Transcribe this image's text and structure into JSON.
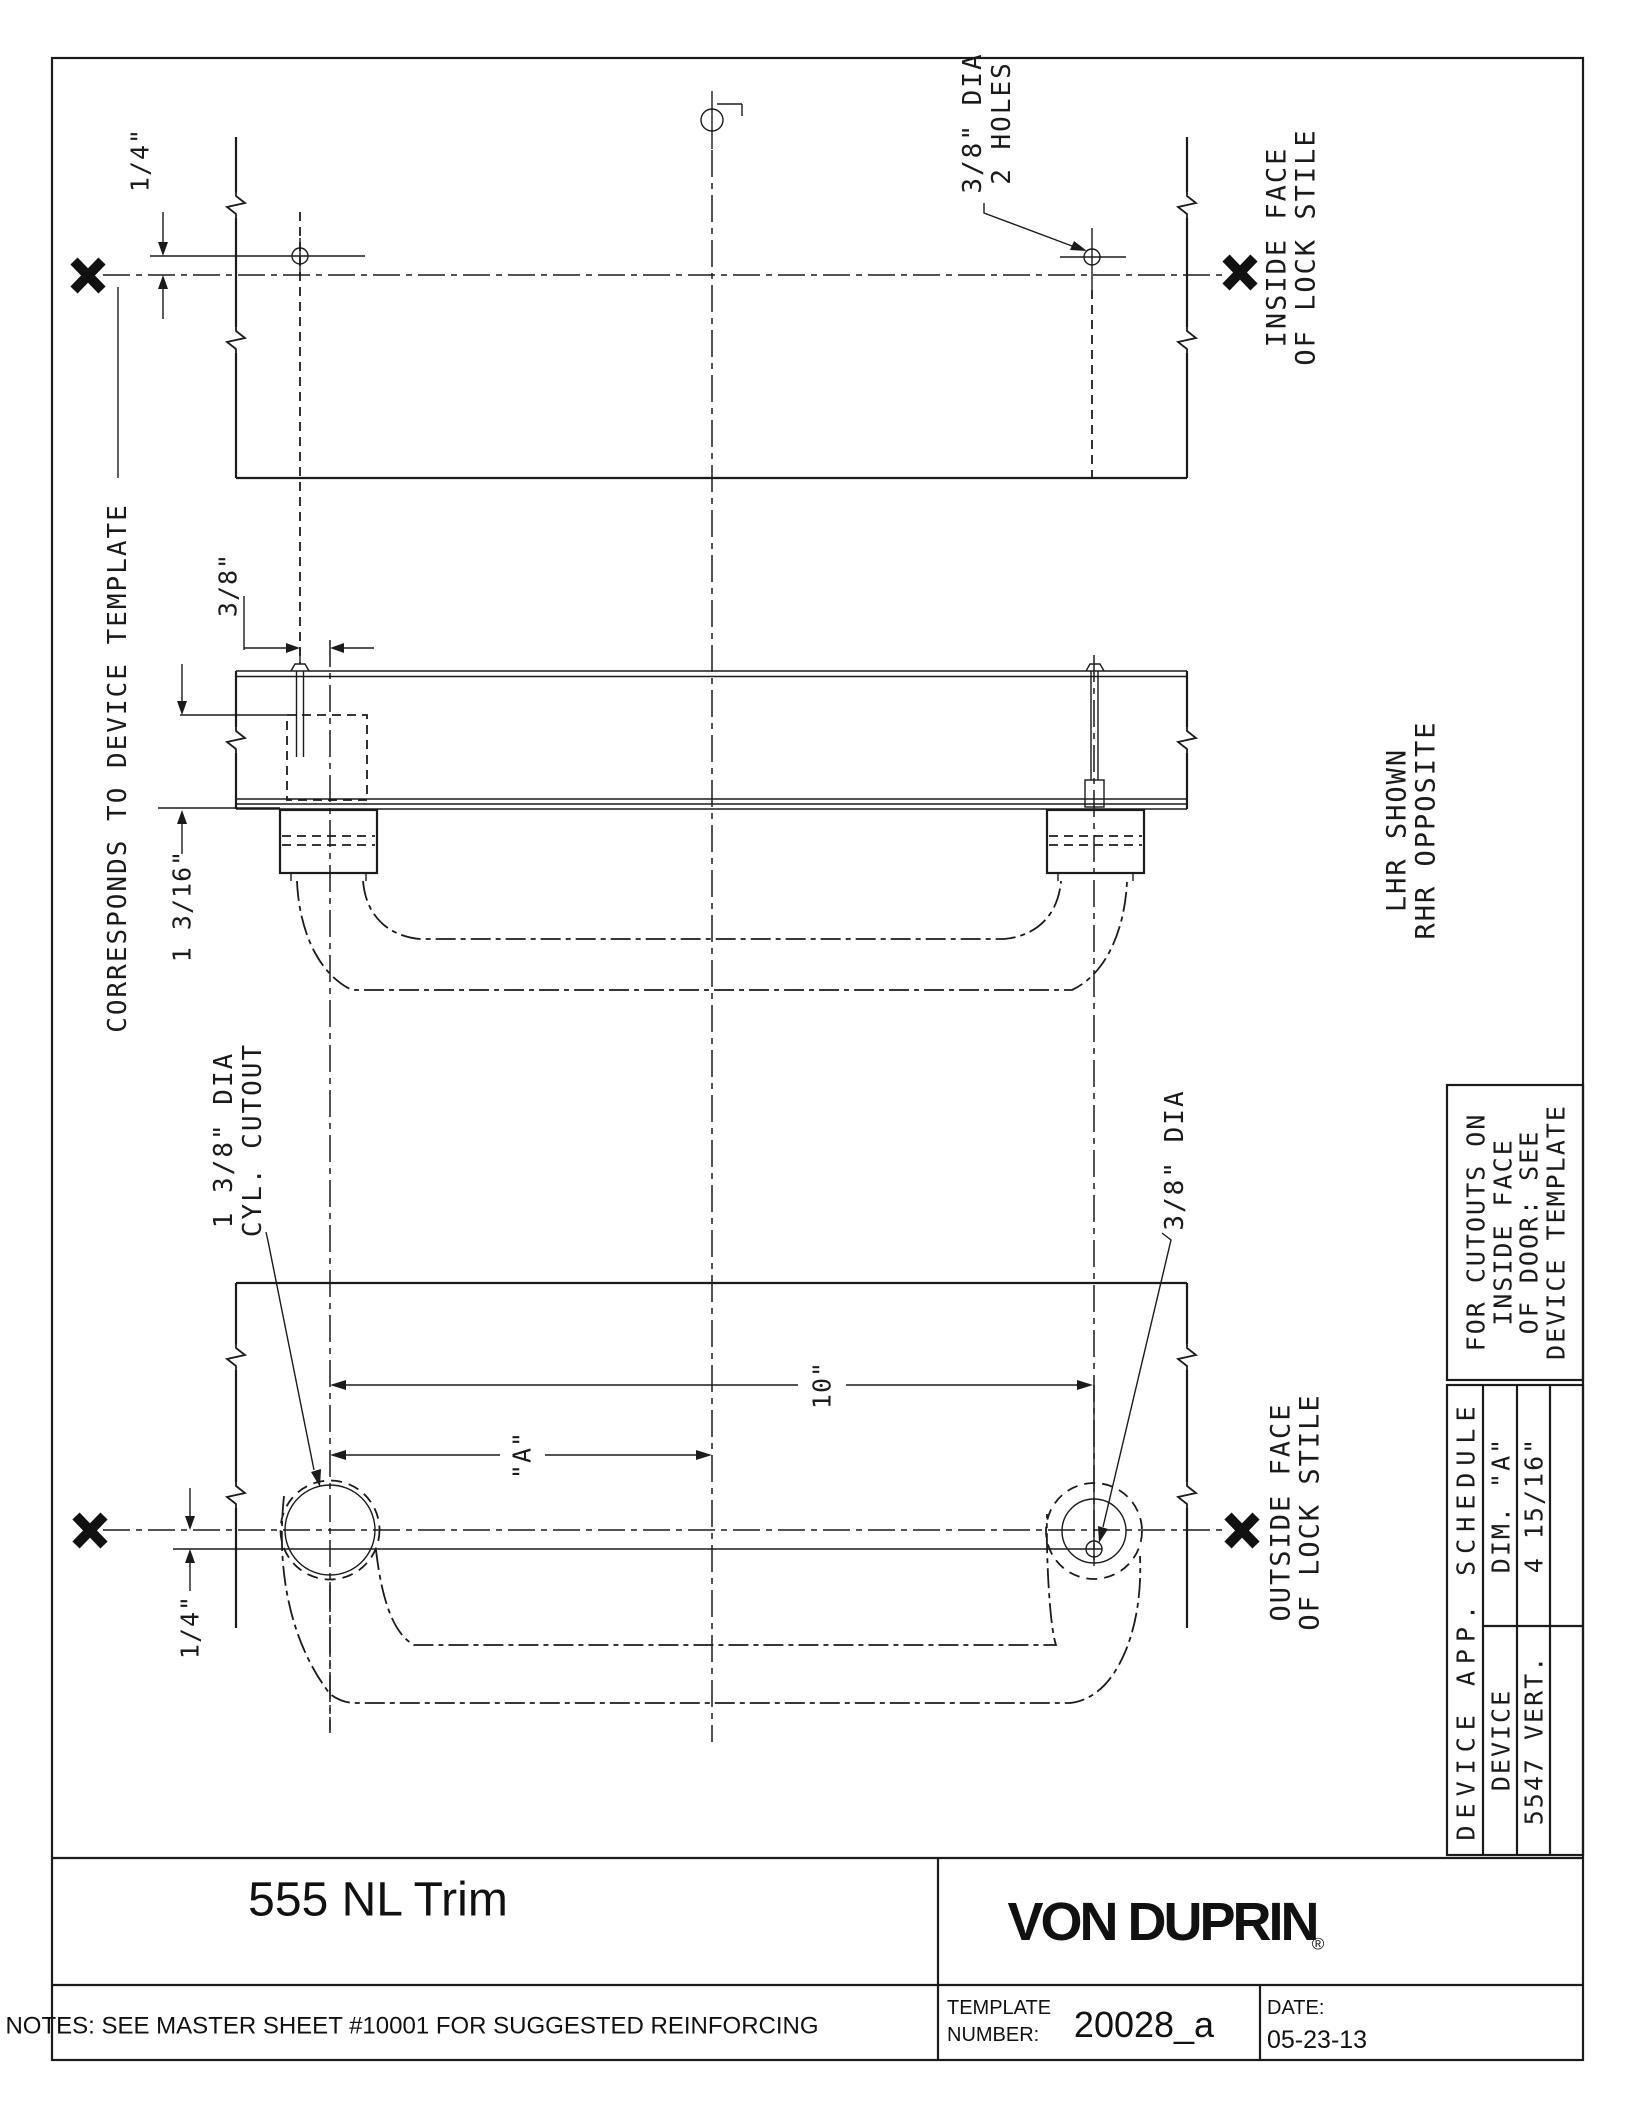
{
  "views": {
    "top": {
      "dim_quarter": "1/4\"",
      "holes_note_line1": "3/8\" DIA",
      "holes_note_line2": "2 HOLES",
      "stile_label_line1": "INSIDE FACE",
      "stile_label_line2": "OF LOCK STILE"
    },
    "middle": {
      "dim_three_eighths": "3/8\"",
      "dim_one_three_sixteenths": "1 3/16\"",
      "corresponds_label": "CORRESPONDS TO DEVICE TEMPLATE",
      "handing_line1": "LHR SHOWN",
      "handing_line2": "RHR OPPOSITE"
    },
    "bottom": {
      "cutout_note_line1": "1 3/8\" DIA",
      "cutout_note_line2": "CYL. CUTOUT",
      "dim_ten": "10\"",
      "dim_a": "\"A\"",
      "hole_note": "3/8\" DIA",
      "dim_quarter": "1/4\"",
      "stile_label_line1": "OUTSIDE FACE",
      "stile_label_line2": "OF LOCK STILE"
    }
  },
  "cutout_box": {
    "line1": "FOR CUTOUTS ON",
    "line2": "INSIDE FACE",
    "line3": "OF DOOR: SEE",
    "line4": "DEVICE TEMPLATE"
  },
  "schedule": {
    "title": "DEVICE APP. SCHEDULE",
    "col_device": "DEVICE",
    "col_dim": "DIM. \"A\"",
    "row_device": "5547 VERT.",
    "row_dim": "4 15/16\""
  },
  "title_block": {
    "title": "555 NL Trim",
    "brand": "VON DUPRIN",
    "brand_reg": "®",
    "notes": "NOTES: SEE MASTER SHEET #10001 FOR SUGGESTED REINFORCING",
    "template_label_line1": "TEMPLATE",
    "template_label_line2": "NUMBER:",
    "template_number": "20028_a",
    "date_label": "DATE:",
    "date_value": "05-23-13"
  }
}
